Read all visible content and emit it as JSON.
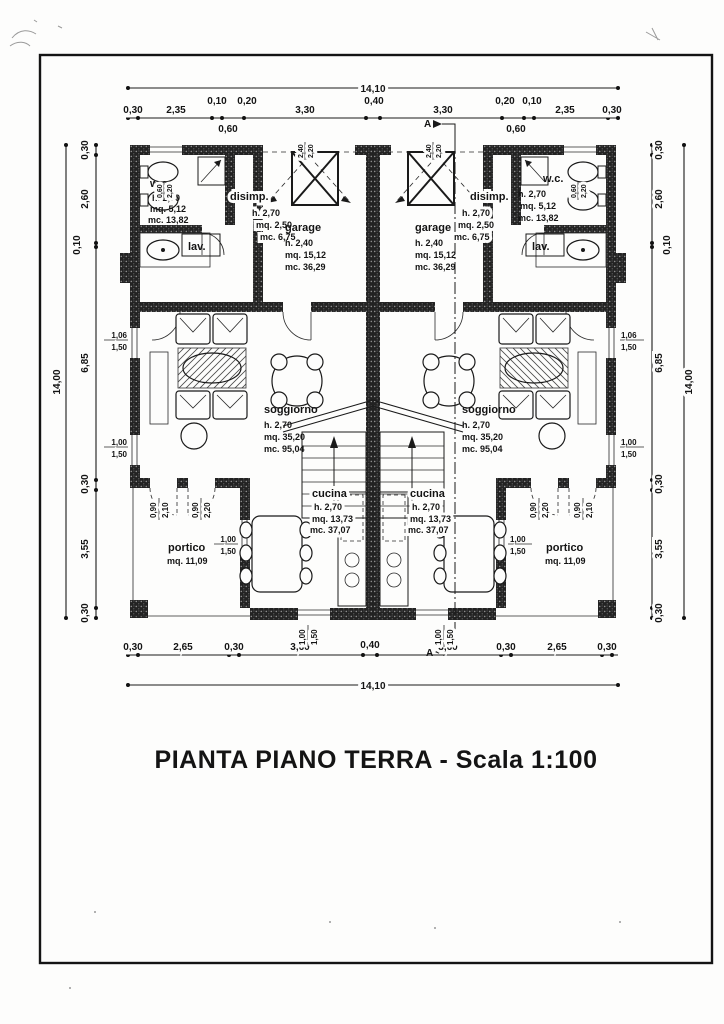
{
  "title": "PIANTA PIANO TERRA - Scala 1:100",
  "section_label": "A",
  "rooms": {
    "wc": {
      "name": "w.c.",
      "h": "h. 2,70",
      "mq": "mq. 5,12",
      "mc": "mc. 13,82"
    },
    "disimp": {
      "name": "disimp.",
      "h": "h. 2,70",
      "mq": "mq. 2,50",
      "mc": "mc. 6,75"
    },
    "lav": {
      "name": "lav."
    },
    "garage": {
      "name": "garage",
      "h": "h. 2,40",
      "mq": "mq. 15,12",
      "mc": "mc. 36,29"
    },
    "soggiorno": {
      "name": "soggiorno",
      "h": "h. 2,70",
      "mq": "mq. 35,20",
      "mc": "mc. 95,04"
    },
    "cucina": {
      "name": "cucina",
      "h": "h. 2,70",
      "mq": "mq. 13,73",
      "mc": "mc. 37,07"
    },
    "portico": {
      "name": "portico",
      "mq": "mq. 11,09"
    }
  },
  "dims": {
    "top_overall": "14,10",
    "top": [
      "0,30",
      "2,35",
      "0,10",
      "0,20",
      "0,60",
      "3,30",
      "0,40",
      "3,30",
      "0,60",
      "0,20",
      "0,10",
      "2,35",
      "0,30"
    ],
    "bottom_overall": "14,10",
    "bottom": [
      "0,30",
      "2,65",
      "0,30",
      "3,60",
      "0,40",
      "3,60",
      "0,30",
      "2,65",
      "0,30"
    ],
    "left_overall": "14,00",
    "left": [
      "0,30",
      "2,60",
      "0,10",
      "6,85",
      "0,30",
      "3,55",
      "0,30"
    ],
    "right_overall": "14,00",
    "right": [
      "0,30",
      "2,60",
      "0,10",
      "6,85",
      "0,30",
      "3,55",
      "0,30"
    ]
  },
  "openings": {
    "window_large": {
      "w": "1,06",
      "h": "1,50"
    },
    "window_std": {
      "w": "1,00",
      "h": "1,50"
    },
    "door_220": {
      "w": "0,90",
      "h": "2,20"
    },
    "door_210": {
      "w": "0,90",
      "h": "2,10"
    },
    "garage_door": {
      "w": "2,40",
      "h": "2,20"
    },
    "window_small": {
      "w": "0,60",
      "h": "2,20"
    }
  }
}
